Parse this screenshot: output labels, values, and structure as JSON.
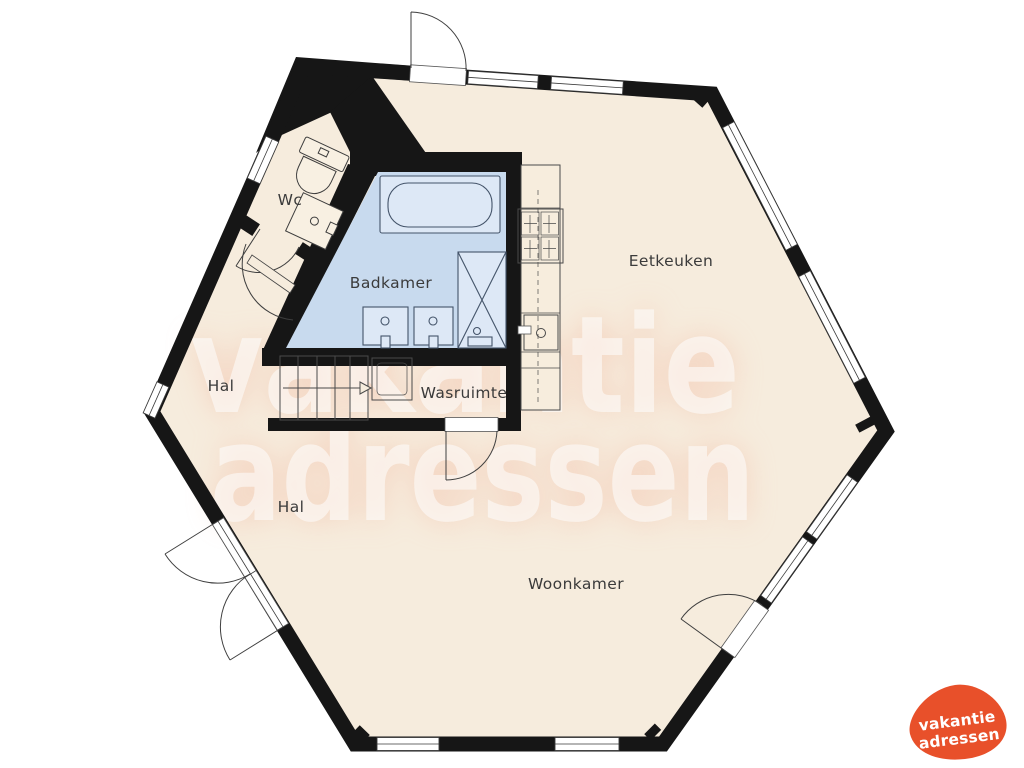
{
  "rooms": {
    "wc": "Wc",
    "badkamer": "Badkamer",
    "hal_boven": "Hal",
    "wasruimte": "Wasruimte",
    "eetkeuken": "Eetkeuken",
    "hal_onder": "Hal",
    "woonkamer": "Woonkamer"
  },
  "watermark": {
    "line1": "vakantie",
    "line2": "adressen"
  },
  "logo": {
    "line1": "vakantie",
    "line2": "adressen"
  },
  "colors": {
    "wall": "#161616",
    "floor": "#f6ecdd",
    "bathroom_floor": "#c8daee",
    "bathroom_fixture": "#dde8f6",
    "watermark_glow": "#f3b9a2",
    "watermark_text": "#ffffff",
    "logo_orange": "#e8502a",
    "label": "#3b3b3b"
  }
}
